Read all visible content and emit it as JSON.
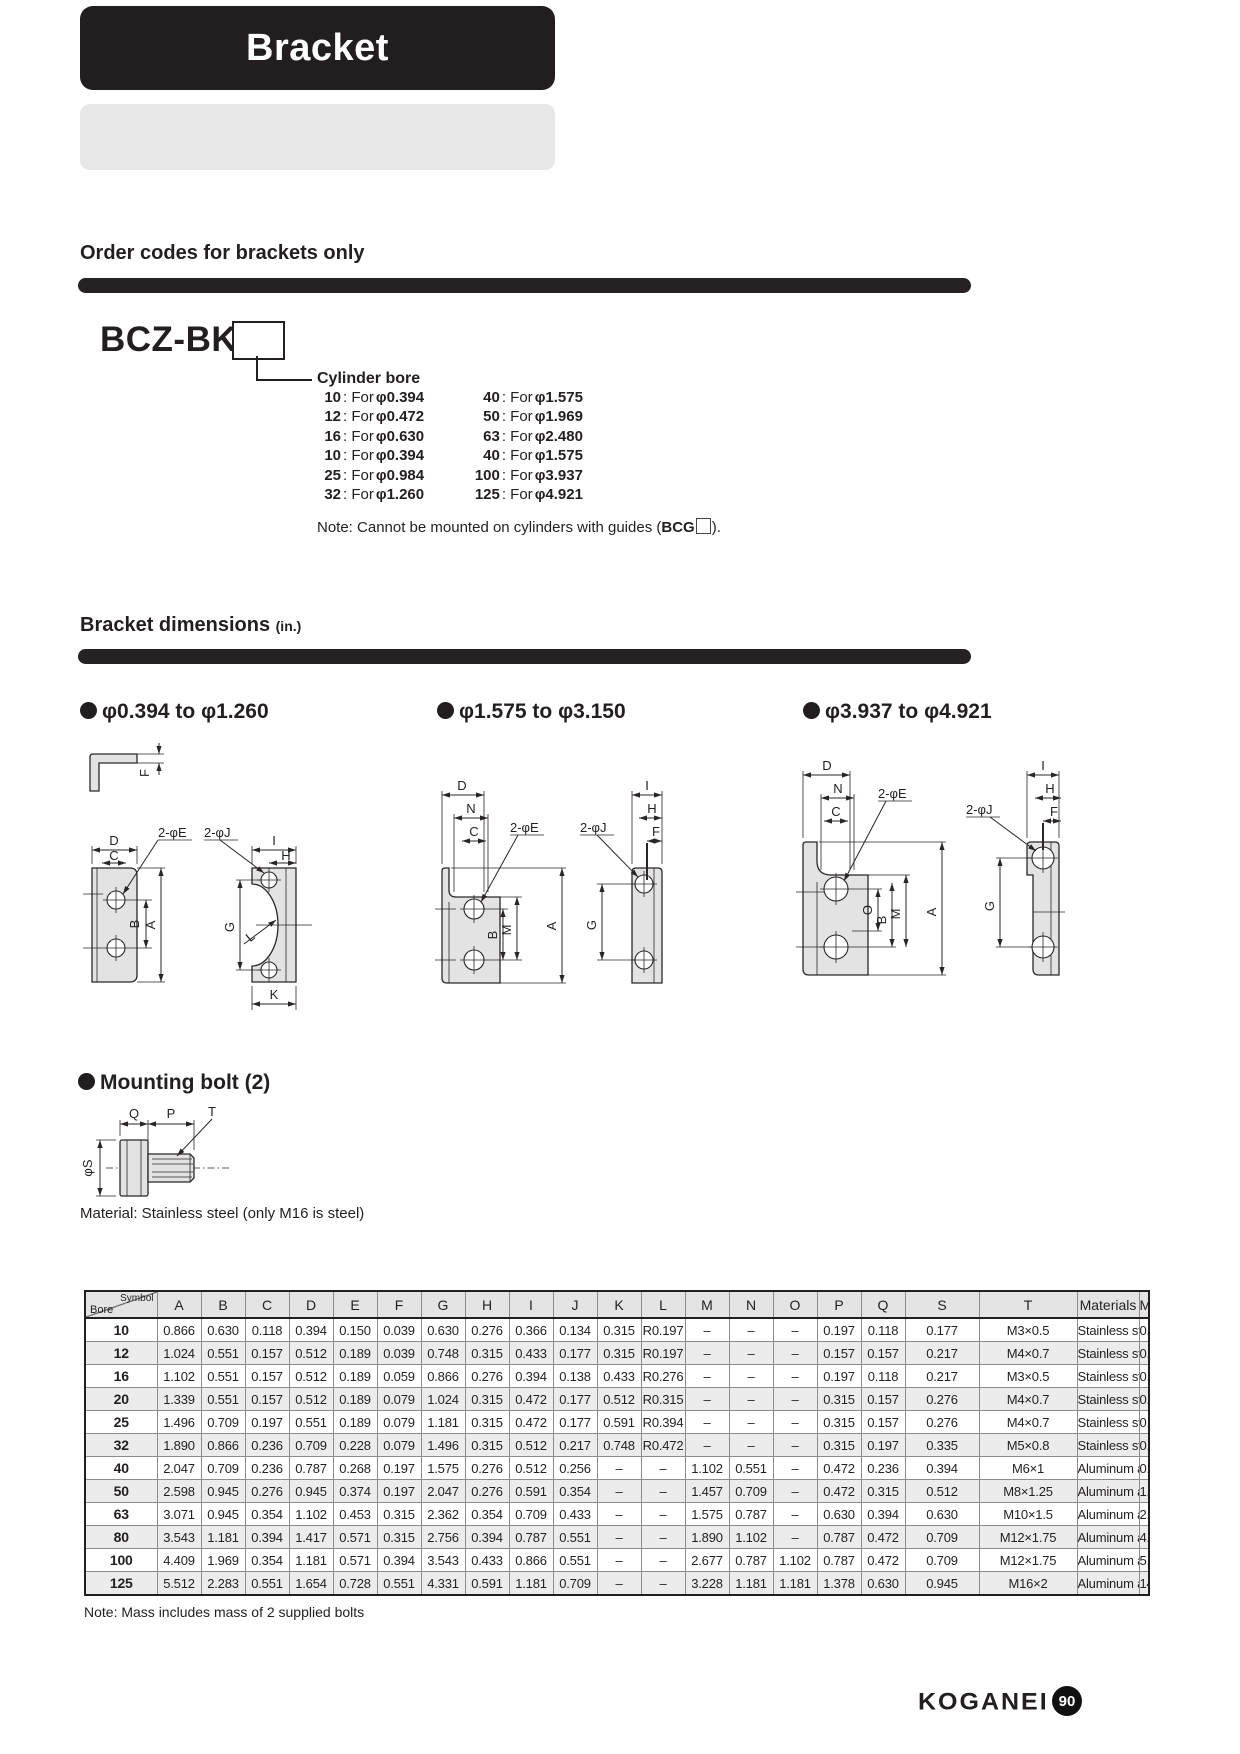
{
  "page": {
    "banner_title": "Bracket",
    "footer_brand": "KOGANEI",
    "page_number": "90"
  },
  "order_section": {
    "heading": "Order codes for brackets only",
    "model_code": "BCZ-BK",
    "callout_title": "Cylinder bore",
    "for_text": ": For",
    "bore_options": [
      {
        "c1": "10",
        "v1": "φ0.394",
        "c2": "40",
        "v2": "φ1.575"
      },
      {
        "c1": "12",
        "v1": "φ0.472",
        "c2": "50",
        "v2": "φ1.969"
      },
      {
        "c1": "16",
        "v1": "φ0.630",
        "c2": "63",
        "v2": "φ2.480"
      },
      {
        "c1": "10",
        "v1": "φ0.394",
        "c2": "40",
        "v2": "φ1.575"
      },
      {
        "c1": "25",
        "v1": "φ0.984",
        "c2": "100",
        "v2": "φ3.937"
      },
      {
        "c1": "32",
        "v1": "φ1.260",
        "c2": "125",
        "v2": "φ4.921"
      }
    ],
    "note_prefix": "Note: Cannot be mounted on cylinders with guides (",
    "note_code": "BCG",
    "note_suffix": ")."
  },
  "dimensions_section": {
    "heading": "Bracket dimensions",
    "heading_unit": "(in.)",
    "groups": [
      {
        "range": "φ0.394 to φ1.260"
      },
      {
        "range": "φ1.575 to φ3.150"
      },
      {
        "range": "φ3.937 to φ4.921"
      }
    ],
    "labels1": {
      "F": "F",
      "D": "D",
      "C": "C",
      "E": "2-φE",
      "J": "2-φJ",
      "I": "I",
      "H": "H",
      "B": "B",
      "A": "A",
      "G": "G",
      "L": "L",
      "K": "K"
    },
    "labels2": {
      "D": "D",
      "N": "N",
      "C": "C",
      "E": "2-φE",
      "J": "2-φJ",
      "I": "I",
      "H": "H",
      "F": "F",
      "B": "B",
      "M": "M",
      "A": "A",
      "G": "G"
    },
    "labels3": {
      "D": "D",
      "N": "N",
      "C": "C",
      "E": "2-φE",
      "J": "2-φJ",
      "I": "I",
      "H": "H",
      "F": "F",
      "O": "O",
      "B": "B",
      "M": "M",
      "A": "A",
      "G": "G"
    },
    "mounting_bolt": {
      "heading": "Mounting bolt (2)",
      "labels": {
        "Q": "Q",
        "P": "P",
        "T": "T",
        "S": "φS"
      },
      "material_note": "Material: Stainless steel (only M16 is steel)"
    }
  },
  "table": {
    "corner_top": "Symbol",
    "corner_bottom": "Bore",
    "columns": [
      "A",
      "B",
      "C",
      "D",
      "E",
      "F",
      "G",
      "H",
      "I",
      "J",
      "K",
      "L",
      "M",
      "N",
      "O",
      "P",
      "Q",
      "S",
      "T",
      "Materials",
      "Mass (oz)"
    ],
    "rows": [
      [
        "10",
        "0.866",
        "0.630",
        "0.118",
        "0.394",
        "0.150",
        "0.039",
        "0.630",
        "0.276",
        "0.366",
        "0.134",
        "0.315",
        "R0.197",
        "–",
        "–",
        "–",
        "0.197",
        "0.118",
        "0.177",
        "M3×0.5",
        "Stainless steel",
        "0.14"
      ],
      [
        "12",
        "1.024",
        "0.551",
        "0.157",
        "0.512",
        "0.189",
        "0.039",
        "0.748",
        "0.315",
        "0.433",
        "0.177",
        "0.315",
        "R0.197",
        "–",
        "–",
        "–",
        "0.157",
        "0.157",
        "0.217",
        "M4×0.7",
        "Stainless steel",
        "0.21"
      ],
      [
        "16",
        "1.102",
        "0.551",
        "0.157",
        "0.512",
        "0.189",
        "0.059",
        "0.866",
        "0.276",
        "0.394",
        "0.138",
        "0.433",
        "R0.276",
        "–",
        "–",
        "–",
        "0.197",
        "0.118",
        "0.217",
        "M3×0.5",
        "Stainless steel",
        "0.25"
      ],
      [
        "20",
        "1.339",
        "0.551",
        "0.157",
        "0.512",
        "0.189",
        "0.079",
        "1.024",
        "0.315",
        "0.472",
        "0.177",
        "0.512",
        "R0.315",
        "–",
        "–",
        "–",
        "0.315",
        "0.157",
        "0.276",
        "M4×0.7",
        "Stainless steel",
        "0.42"
      ],
      [
        "25",
        "1.496",
        "0.709",
        "0.197",
        "0.551",
        "0.189",
        "0.079",
        "1.181",
        "0.315",
        "0.472",
        "0.177",
        "0.591",
        "R0.394",
        "–",
        "–",
        "–",
        "0.315",
        "0.157",
        "0.276",
        "M4×0.7",
        "Stainless steel",
        "0.49"
      ],
      [
        "32",
        "1.890",
        "0.866",
        "0.236",
        "0.709",
        "0.228",
        "0.079",
        "1.496",
        "0.315",
        "0.512",
        "0.217",
        "0.748",
        "R0.472",
        "–",
        "–",
        "–",
        "0.315",
        "0.197",
        "0.335",
        "M5×0.8",
        "Stainless steel",
        "0.85"
      ],
      [
        "40",
        "2.047",
        "0.709",
        "0.236",
        "0.787",
        "0.268",
        "0.197",
        "1.575",
        "0.276",
        "0.512",
        "0.256",
        "–",
        "–",
        "1.102",
        "0.551",
        "–",
        "0.472",
        "0.236",
        "0.394",
        "M6×1",
        "Aluminum alloy",
        "0.88"
      ],
      [
        "50",
        "2.598",
        "0.945",
        "0.276",
        "0.945",
        "0.374",
        "0.197",
        "2.047",
        "0.276",
        "0.591",
        "0.354",
        "–",
        "–",
        "1.457",
        "0.709",
        "–",
        "0.472",
        "0.315",
        "0.512",
        "M8×1.25",
        "Aluminum alloy",
        "1.59"
      ],
      [
        "63",
        "3.071",
        "0.945",
        "0.354",
        "1.102",
        "0.453",
        "0.315",
        "2.362",
        "0.354",
        "0.709",
        "0.433",
        "–",
        "–",
        "1.575",
        "0.787",
        "–",
        "0.630",
        "0.394",
        "0.630",
        "M10×1.5",
        "Aluminum alloy",
        "2.82"
      ],
      [
        "80",
        "3.543",
        "1.181",
        "0.394",
        "1.417",
        "0.571",
        "0.315",
        "2.756",
        "0.394",
        "0.787",
        "0.551",
        "–",
        "–",
        "1.890",
        "1.102",
        "–",
        "0.787",
        "0.472",
        "0.709",
        "M12×1.75",
        "Aluminum alloy",
        "4.51"
      ],
      [
        "100",
        "4.409",
        "1.969",
        "0.354",
        "1.181",
        "0.571",
        "0.394",
        "3.543",
        "0.433",
        "0.866",
        "0.551",
        "–",
        "–",
        "2.677",
        "0.787",
        "1.102",
        "0.787",
        "0.472",
        "0.709",
        "M12×1.75",
        "Aluminum alloy",
        "5.89"
      ],
      [
        "125",
        "5.512",
        "2.283",
        "0.551",
        "1.654",
        "0.728",
        "0.551",
        "4.331",
        "0.591",
        "1.181",
        "0.709",
        "–",
        "–",
        "3.228",
        "1.181",
        "1.181",
        "1.378",
        "0.630",
        "0.945",
        "M16×2",
        "Aluminum alloy",
        "14.46"
      ]
    ],
    "note": "Note: Mass includes mass of 2 supplied bolts"
  }
}
